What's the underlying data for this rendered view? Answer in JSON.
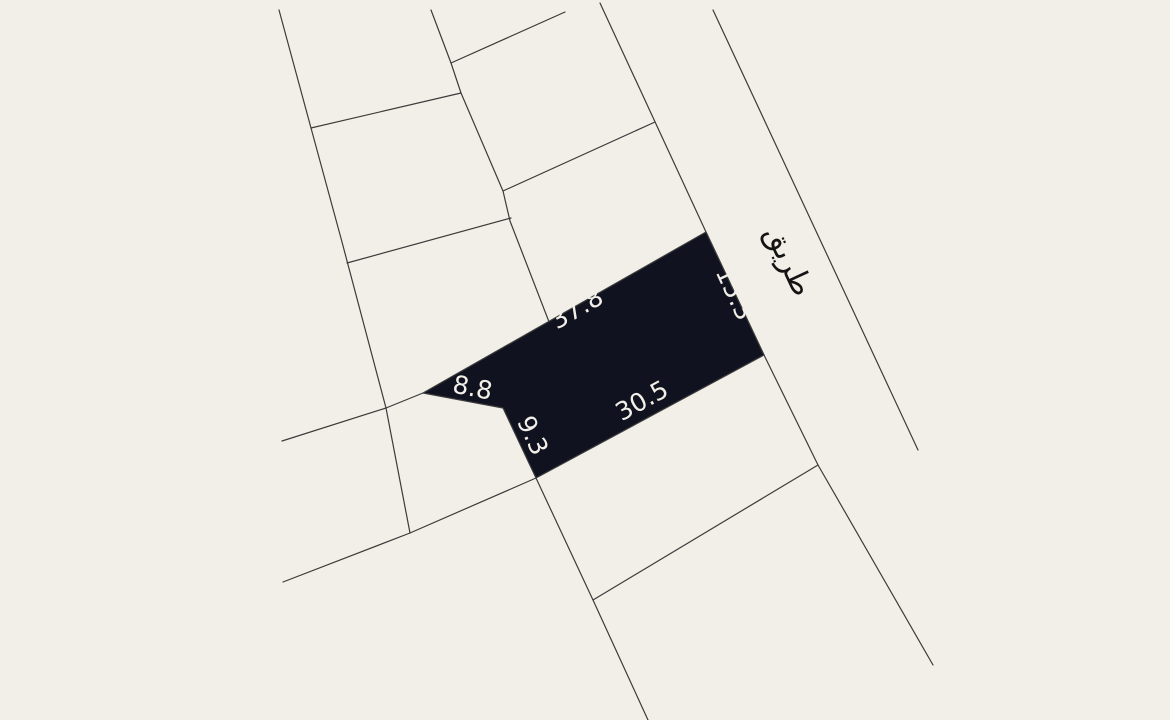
{
  "map": {
    "type": "cadastral-parcel-map",
    "background_color": "#f2efe8",
    "line_color": "#3b3b3b",
    "line_width": 1.2,
    "canvas": {
      "width": 1170,
      "height": 720
    },
    "road": {
      "label": "طريق",
      "label_color": "#141414",
      "label_font_size": 30,
      "label_position": {
        "x": 780,
        "y": 265,
        "angle": 65
      }
    },
    "highlighted_plot": {
      "fill_color": "#10131f",
      "outline_color": "#3b3b3b",
      "label_color": "#f2efe8",
      "label_font_size": 25,
      "polygon_points": [
        [
          423,
          393
        ],
        [
          706,
          232
        ],
        [
          764,
          355
        ],
        [
          536,
          478
        ],
        [
          503,
          408
        ]
      ],
      "dimension_labels": [
        {
          "value": "37.8",
          "side": "north",
          "x": 581,
          "y": 316,
          "angle": -30
        },
        {
          "value": "15.3",
          "side": "east",
          "x": 727,
          "y": 297,
          "angle": 65
        },
        {
          "value": "30.5",
          "side": "south",
          "x": 646,
          "y": 408,
          "angle": -29
        },
        {
          "value": "8.8",
          "side": "northwest-notch",
          "x": 471,
          "y": 396,
          "angle": 11
        },
        {
          "value": "9.3",
          "side": "west",
          "x": 525,
          "y": 439,
          "angle": 65
        }
      ]
    },
    "boundary_lines": [
      {
        "name": "parcel-line-west-long",
        "points": [
          [
            279,
            10
          ],
          [
            311,
            128
          ],
          [
            342,
            242
          ],
          [
            386,
            408
          ],
          [
            410,
            533
          ]
        ]
      },
      {
        "name": "parcel-line-mid-long",
        "points": [
          [
            431,
            10
          ],
          [
            451,
            63
          ],
          [
            461,
            93
          ],
          [
            503,
            191
          ],
          [
            510,
            221
          ],
          [
            551,
            327
          ]
        ]
      },
      {
        "name": "parcel-cross-north-a",
        "points": [
          [
            311,
            128
          ],
          [
            461,
            93
          ]
        ]
      },
      {
        "name": "parcel-cross-north-b",
        "points": [
          [
            451,
            63
          ],
          [
            565,
            12
          ]
        ]
      },
      {
        "name": "parcel-cross-mid-a",
        "points": [
          [
            503,
            191
          ],
          [
            655,
            122
          ]
        ]
      },
      {
        "name": "parcel-cross-mid-b",
        "points": [
          [
            347,
            263
          ],
          [
            511,
            218
          ]
        ]
      },
      {
        "name": "road-edge-west",
        "points": [
          [
            600,
            3
          ],
          [
            706,
            232
          ],
          [
            764,
            355
          ],
          [
            818,
            465
          ],
          [
            933,
            665
          ]
        ]
      },
      {
        "name": "road-edge-east",
        "points": [
          [
            713,
            10
          ],
          [
            918,
            450
          ]
        ]
      },
      {
        "name": "parcel-stub-west",
        "points": [
          [
            282,
            441
          ],
          [
            386,
            408
          ]
        ]
      },
      {
        "name": "parcel-line-southwest",
        "points": [
          [
            283,
            582
          ],
          [
            410,
            533
          ],
          [
            536,
            478
          ]
        ]
      },
      {
        "name": "parcel-line-south",
        "points": [
          [
            536,
            478
          ],
          [
            593,
            600
          ],
          [
            648,
            720
          ]
        ]
      },
      {
        "name": "parcel-cross-south",
        "points": [
          [
            593,
            600
          ],
          [
            818,
            465
          ]
        ]
      },
      {
        "name": "plot-tip-connector",
        "points": [
          [
            386,
            408
          ],
          [
            423,
            393
          ]
        ]
      }
    ]
  }
}
